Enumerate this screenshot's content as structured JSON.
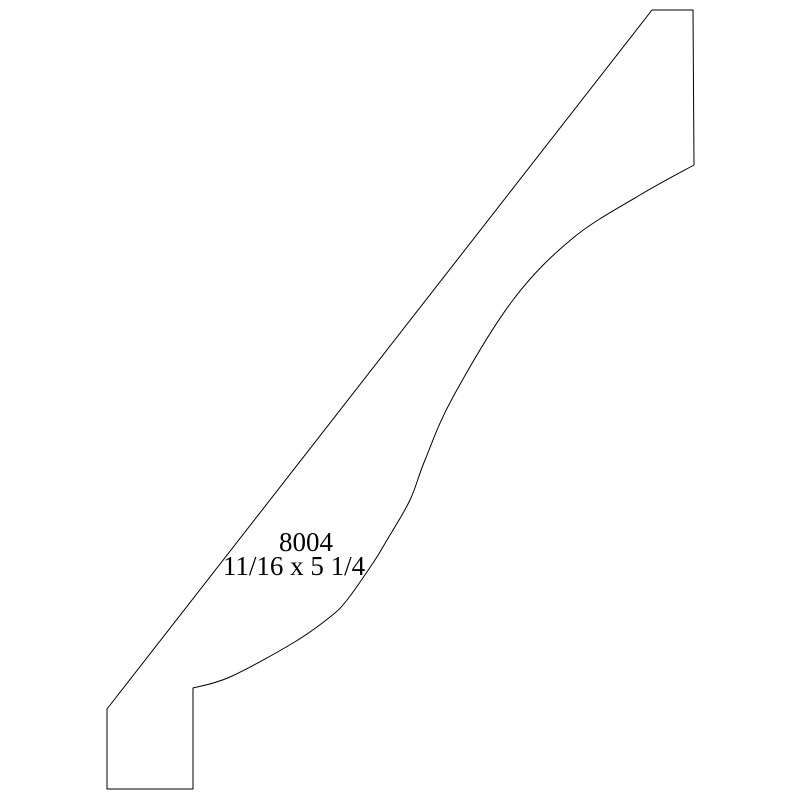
{
  "page": {
    "background_color": "#ffffff"
  },
  "drawing": {
    "type": "molding-profile-cross-section",
    "stroke_color": "#000000",
    "stroke_width": 1,
    "fill_color": "#ffffff",
    "label": {
      "profile_number": "8004",
      "dimensions": "11/16 x 5 1/4"
    },
    "outline": {
      "move": [
        652,
        10
      ],
      "segments": [
        {
          "type": "line",
          "points": [
            [
              693,
              10
            ],
            [
              694,
              165
            ]
          ]
        },
        {
          "type": "curve",
          "points": [
            [
              640,
              195
            ],
            [
              573,
              238
            ],
            [
              513,
              300
            ],
            [
              453,
              397
            ],
            [
              425,
              460
            ],
            [
              410,
              500
            ],
            [
              387,
              540
            ],
            [
              373,
              563
            ],
            [
              347,
              600
            ],
            [
              330,
              617
            ],
            [
              293,
              643
            ],
            [
              230,
              677
            ],
            [
              193,
              688
            ]
          ]
        },
        {
          "type": "line",
          "points": [
            [
              193,
              789
            ],
            [
              107,
              789
            ],
            [
              107,
              709
            ]
          ]
        }
      ],
      "close": true
    }
  }
}
